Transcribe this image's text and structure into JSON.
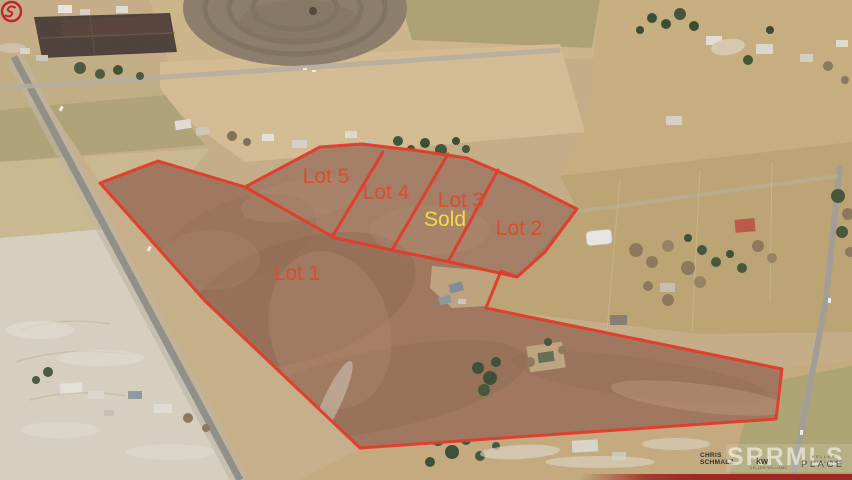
{
  "overlay": {
    "lots": {
      "lot1": {
        "label": "Lot 1"
      },
      "lot2": {
        "label": "Lot 2"
      },
      "lot3": {
        "label": "Lot 3"
      },
      "lot4": {
        "label": "Lot 4"
      },
      "lot5": {
        "label": "Lot 5"
      },
      "sold": {
        "label": "Sold"
      }
    },
    "colors": {
      "boundary": "#e63222",
      "lot_label": "#dd4526",
      "sold_label": "#f2e437"
    }
  },
  "branding": {
    "agent": {
      "line1": "CHRIS",
      "line2": "SCHMALZ",
      "logo_color": "#c2222b"
    },
    "watermark": {
      "text": "SRRMLS"
    },
    "kw": {
      "monogram": "kw",
      "small_text": "KELLER WILLIAMS"
    },
    "office": {
      "small_text": "KELLER WILLIAMS",
      "name": "PLACE"
    }
  }
}
